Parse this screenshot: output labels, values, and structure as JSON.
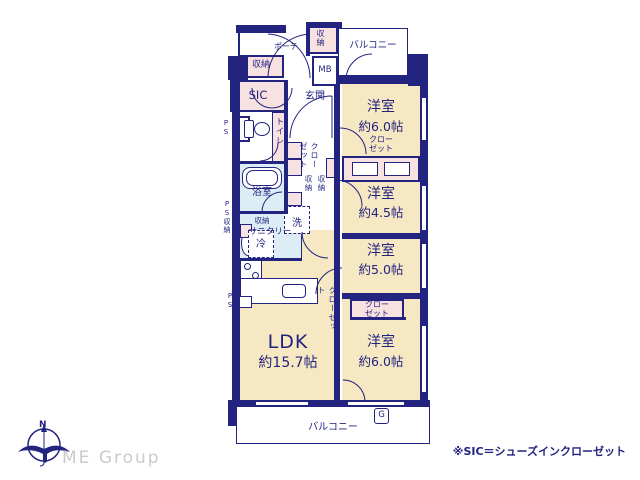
{
  "colors": {
    "wall": "#232380",
    "room_fill": "#f6e8c2",
    "closet_fill": "#f8e1e1",
    "wet_fill": "#dcedf5",
    "text": "#232380",
    "logo_text": "#cbcbcb"
  },
  "rooms": {
    "ldk": {
      "label": "LDK",
      "size": "約15.7帖"
    },
    "bedroom_top": {
      "label": "洋室",
      "size": "約6.0帖"
    },
    "bedroom_mid_upper": {
      "label": "洋室",
      "size": "約4.5帖"
    },
    "bedroom_mid_lower": {
      "label": "洋室",
      "size": "約5.0帖"
    },
    "bedroom_bottom": {
      "label": "洋室",
      "size": "約6.0帖"
    }
  },
  "areas": {
    "balcony": "バルコニー",
    "porch": "ポーチ",
    "entrance": "玄関",
    "sic": "SIC",
    "toilet": "トイレ",
    "bathroom": "浴室",
    "sanitary": "サニタリー",
    "laundry": "洗",
    "refrigerator": "冷",
    "meter_box": "MB",
    "gas": "G"
  },
  "storage": {
    "closet": "クローゼット",
    "closet_line1": "クロー",
    "closet_line2": "ゼット",
    "storage": "収納",
    "pipe_space": "PS"
  },
  "branding": {
    "logo": "ME Group",
    "north": "N"
  },
  "footnote": "※SIC＝シューズインクローゼット"
}
